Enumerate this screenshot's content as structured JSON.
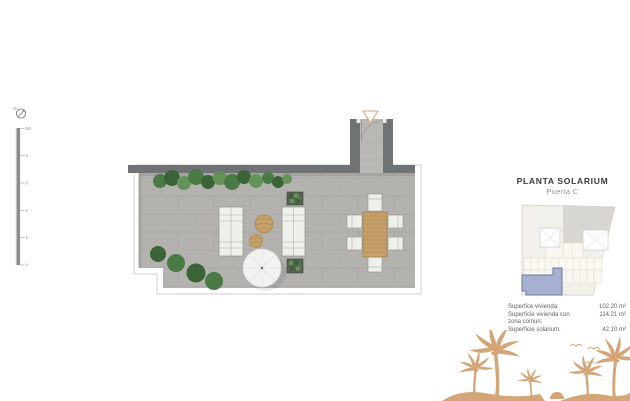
{
  "colors": {
    "c-wall": "#6f7375",
    "c-floor": "#b4b2af",
    "c-floor-light": "#bab8b5",
    "c-wood": "#c5a169",
    "c-plant": "#4c7a46",
    "c-plant-dark": "#3a6337",
    "c-plant-light": "#649258",
    "c-palm": "#d3a577",
    "c-accent": "#d0a87e",
    "c-unit-fill": "#a8b0d1",
    "c-unit-stroke": "#68779f",
    "c-title": "#3b3b3b",
    "c-subtitle": "#979797",
    "c-text": "#5f5f5f"
  },
  "compass": {
    "label": "N"
  },
  "scalebar": {
    "labels": [
      "5m",
      "4",
      "3",
      "2",
      "1",
      "0"
    ]
  },
  "panel": {
    "title": "PLANTA SOLARIUM",
    "subtitle": "Puerta C",
    "areas": [
      {
        "label": "Superfice vivienda:",
        "value": "102.20 m²"
      },
      {
        "label": "Superficie vivienda con",
        "value": "114.21 m²"
      },
      {
        "label": "zona comun:",
        "value": ""
      },
      {
        "label": "Superficie solarium:",
        "value": "42.10 m²"
      }
    ]
  },
  "icons": {
    "compass": "circle-with-north-needle",
    "entrance": "triangle-down-outline",
    "decoration": "palm-trees-and-birds"
  }
}
